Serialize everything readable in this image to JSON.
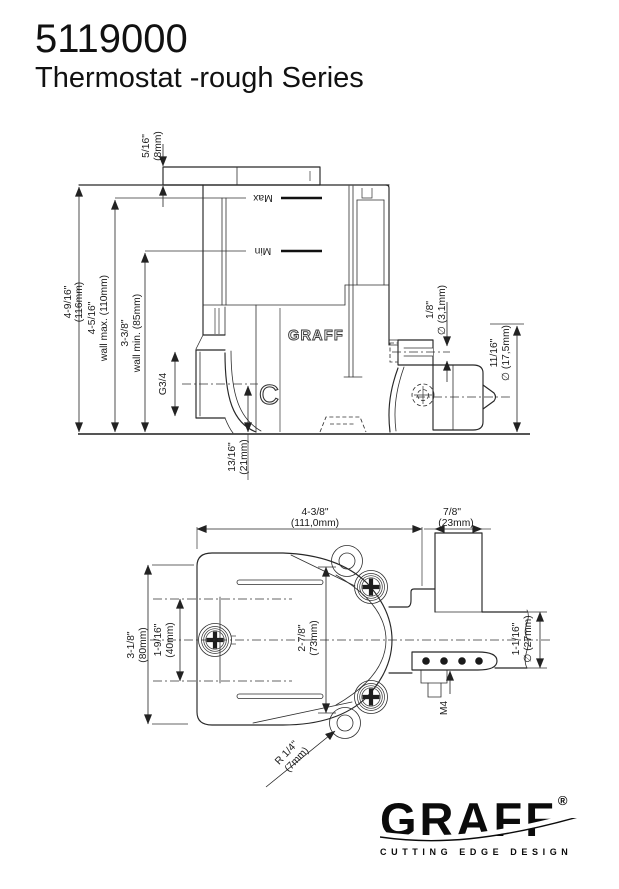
{
  "header": {
    "part_number": "5119000",
    "series_title": "Thermostat -rough Series"
  },
  "side_view": {
    "dim_cap_height": {
      "inch": "5/16\"",
      "mm": "(8mm)"
    },
    "dim_overall": {
      "inch": "4-9/16\"",
      "mm": "(116mm)"
    },
    "dim_wall_max": {
      "inch": "4-5/16\"",
      "mm": "wall max. (110mm)"
    },
    "dim_wall_min": {
      "inch": "3-3/8\"",
      "mm": "wall min. (85mm)"
    },
    "dim_port_thread": "G3/4",
    "dim_outlet_offset": {
      "inch": "13/16\"",
      "mm": "(21mm)"
    },
    "dim_screw_bore": {
      "inch": "1/8\"",
      "mm": "∅ (3,1mm)"
    },
    "dim_cartridge_dia": {
      "inch": "11/16\"",
      "mm": "∅ (17,5mm)"
    },
    "label_max": "Max",
    "label_min": "Min",
    "label_body_logo": "GRAFF",
    "label_c_mark": "C"
  },
  "plan_view": {
    "dim_body_width": {
      "inch": "4-3/8\"",
      "mm": "(111,0mm)"
    },
    "dim_pipe_depth": {
      "inch": "7/8\"",
      "mm": "(23mm)"
    },
    "dim_body_height": {
      "inch": "3-1/8\"",
      "mm": "(80mm)"
    },
    "dim_port_spacing": {
      "inch": "1-9/16\"",
      "mm": "(40mm)"
    },
    "dim_screw_spacing": {
      "inch": "2-7/8\"",
      "mm": "(73mm)"
    },
    "dim_ear_radius": {
      "inch": "R 1/4\"",
      "mm": "(7mm)"
    },
    "dim_thread_label": "M4",
    "dim_pipe_dia": {
      "inch": "1-1/16\"",
      "mm": "∅ (27mm)"
    }
  },
  "footer_logo": {
    "brand": "GRAFF",
    "registered": "®",
    "tagline": "CUTTING EDGE DESIGN"
  }
}
